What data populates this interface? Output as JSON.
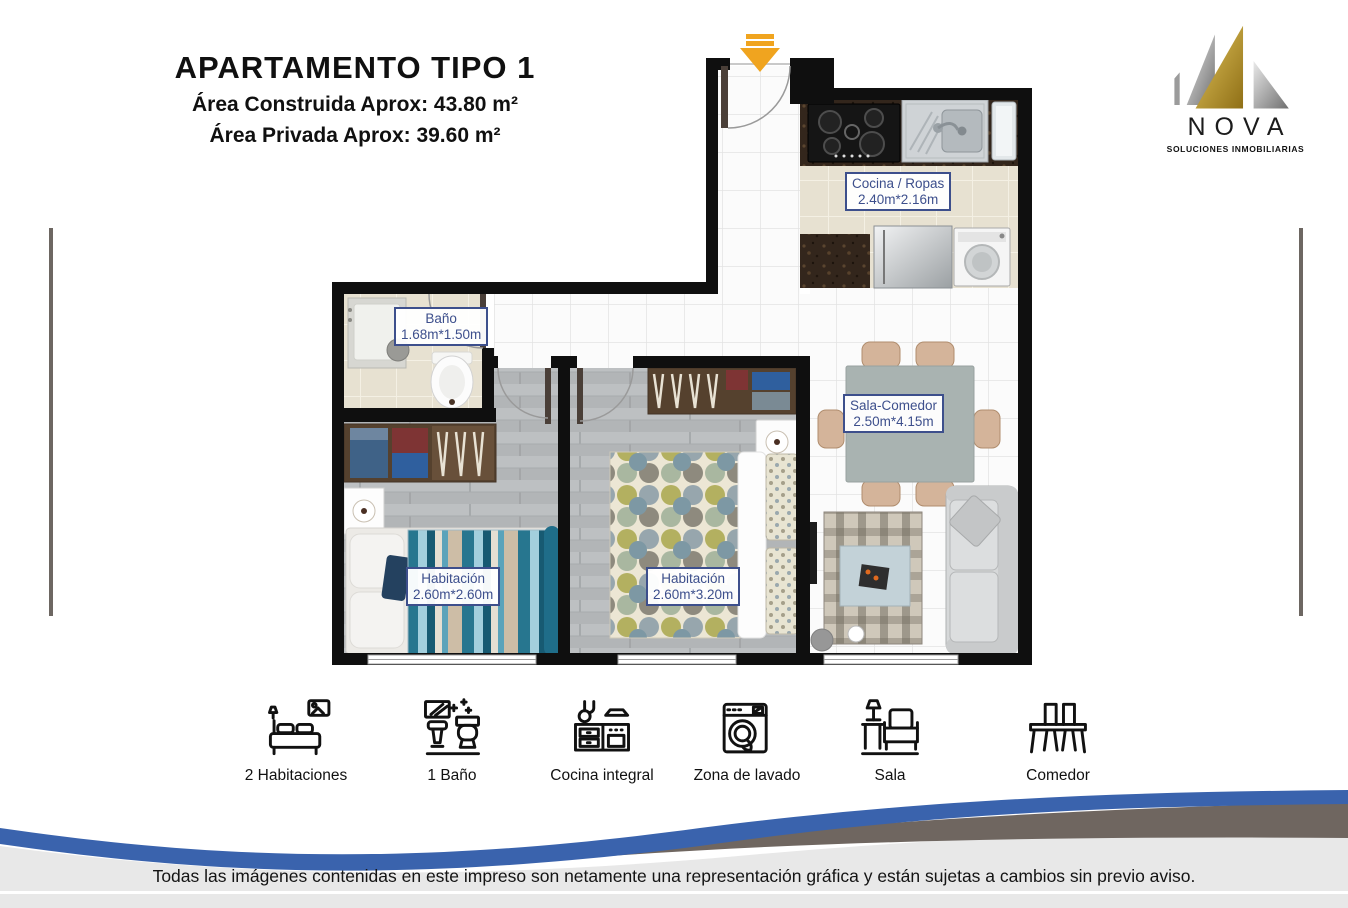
{
  "header": {
    "title": "APARTAMENTO TIPO 1",
    "area_construida": "Área Construida Aprox: 43.80 m²",
    "area_privada": "Área Privada Aprox: 39.60 m²"
  },
  "logo": {
    "name": "NOVA",
    "tagline": "SOLUCIONES INMOBILIARIAS"
  },
  "floorplan": {
    "rooms": [
      {
        "id": "cocina",
        "name": "Cocina / Ropas",
        "dims": "2.40m*2.16m"
      },
      {
        "id": "bano",
        "name": "Baño",
        "dims": "1.68m*1.50m"
      },
      {
        "id": "sala-comedor",
        "name": "Sala-Comedor",
        "dims": "2.50m*4.15m"
      },
      {
        "id": "habitacion-1",
        "name": "Habitación",
        "dims": "2.60m*2.60m"
      },
      {
        "id": "habitacion-2",
        "name": "Habitación",
        "dims": "2.60m*3.20m"
      }
    ]
  },
  "amenities": [
    {
      "icon": "bed-icon",
      "label": "2 Habitaciones"
    },
    {
      "icon": "bathroom-icon",
      "label": "1 Baño"
    },
    {
      "icon": "kitchen-icon",
      "label": "Cocina integral"
    },
    {
      "icon": "laundry-icon",
      "label": "Zona de lavado"
    },
    {
      "icon": "sofa-icon",
      "label": "Sala"
    },
    {
      "icon": "dining-icon",
      "label": "Comedor"
    }
  ],
  "footer": {
    "disclaimer": "Todas las imágenes contenidas en este impreso son netamente una representación gráfica y están sujetas a cambios sin previo aviso."
  },
  "colors": {
    "label_blue": "#3d4f8c",
    "arrow_orange": "#f0a41f",
    "wave_blue": "#3a63ad",
    "wave_taupe": "#6f6660",
    "footer_gray": "#e8e8e8",
    "logo_gold": "#b8952f",
    "logo_silver": "#a7a7a7"
  }
}
